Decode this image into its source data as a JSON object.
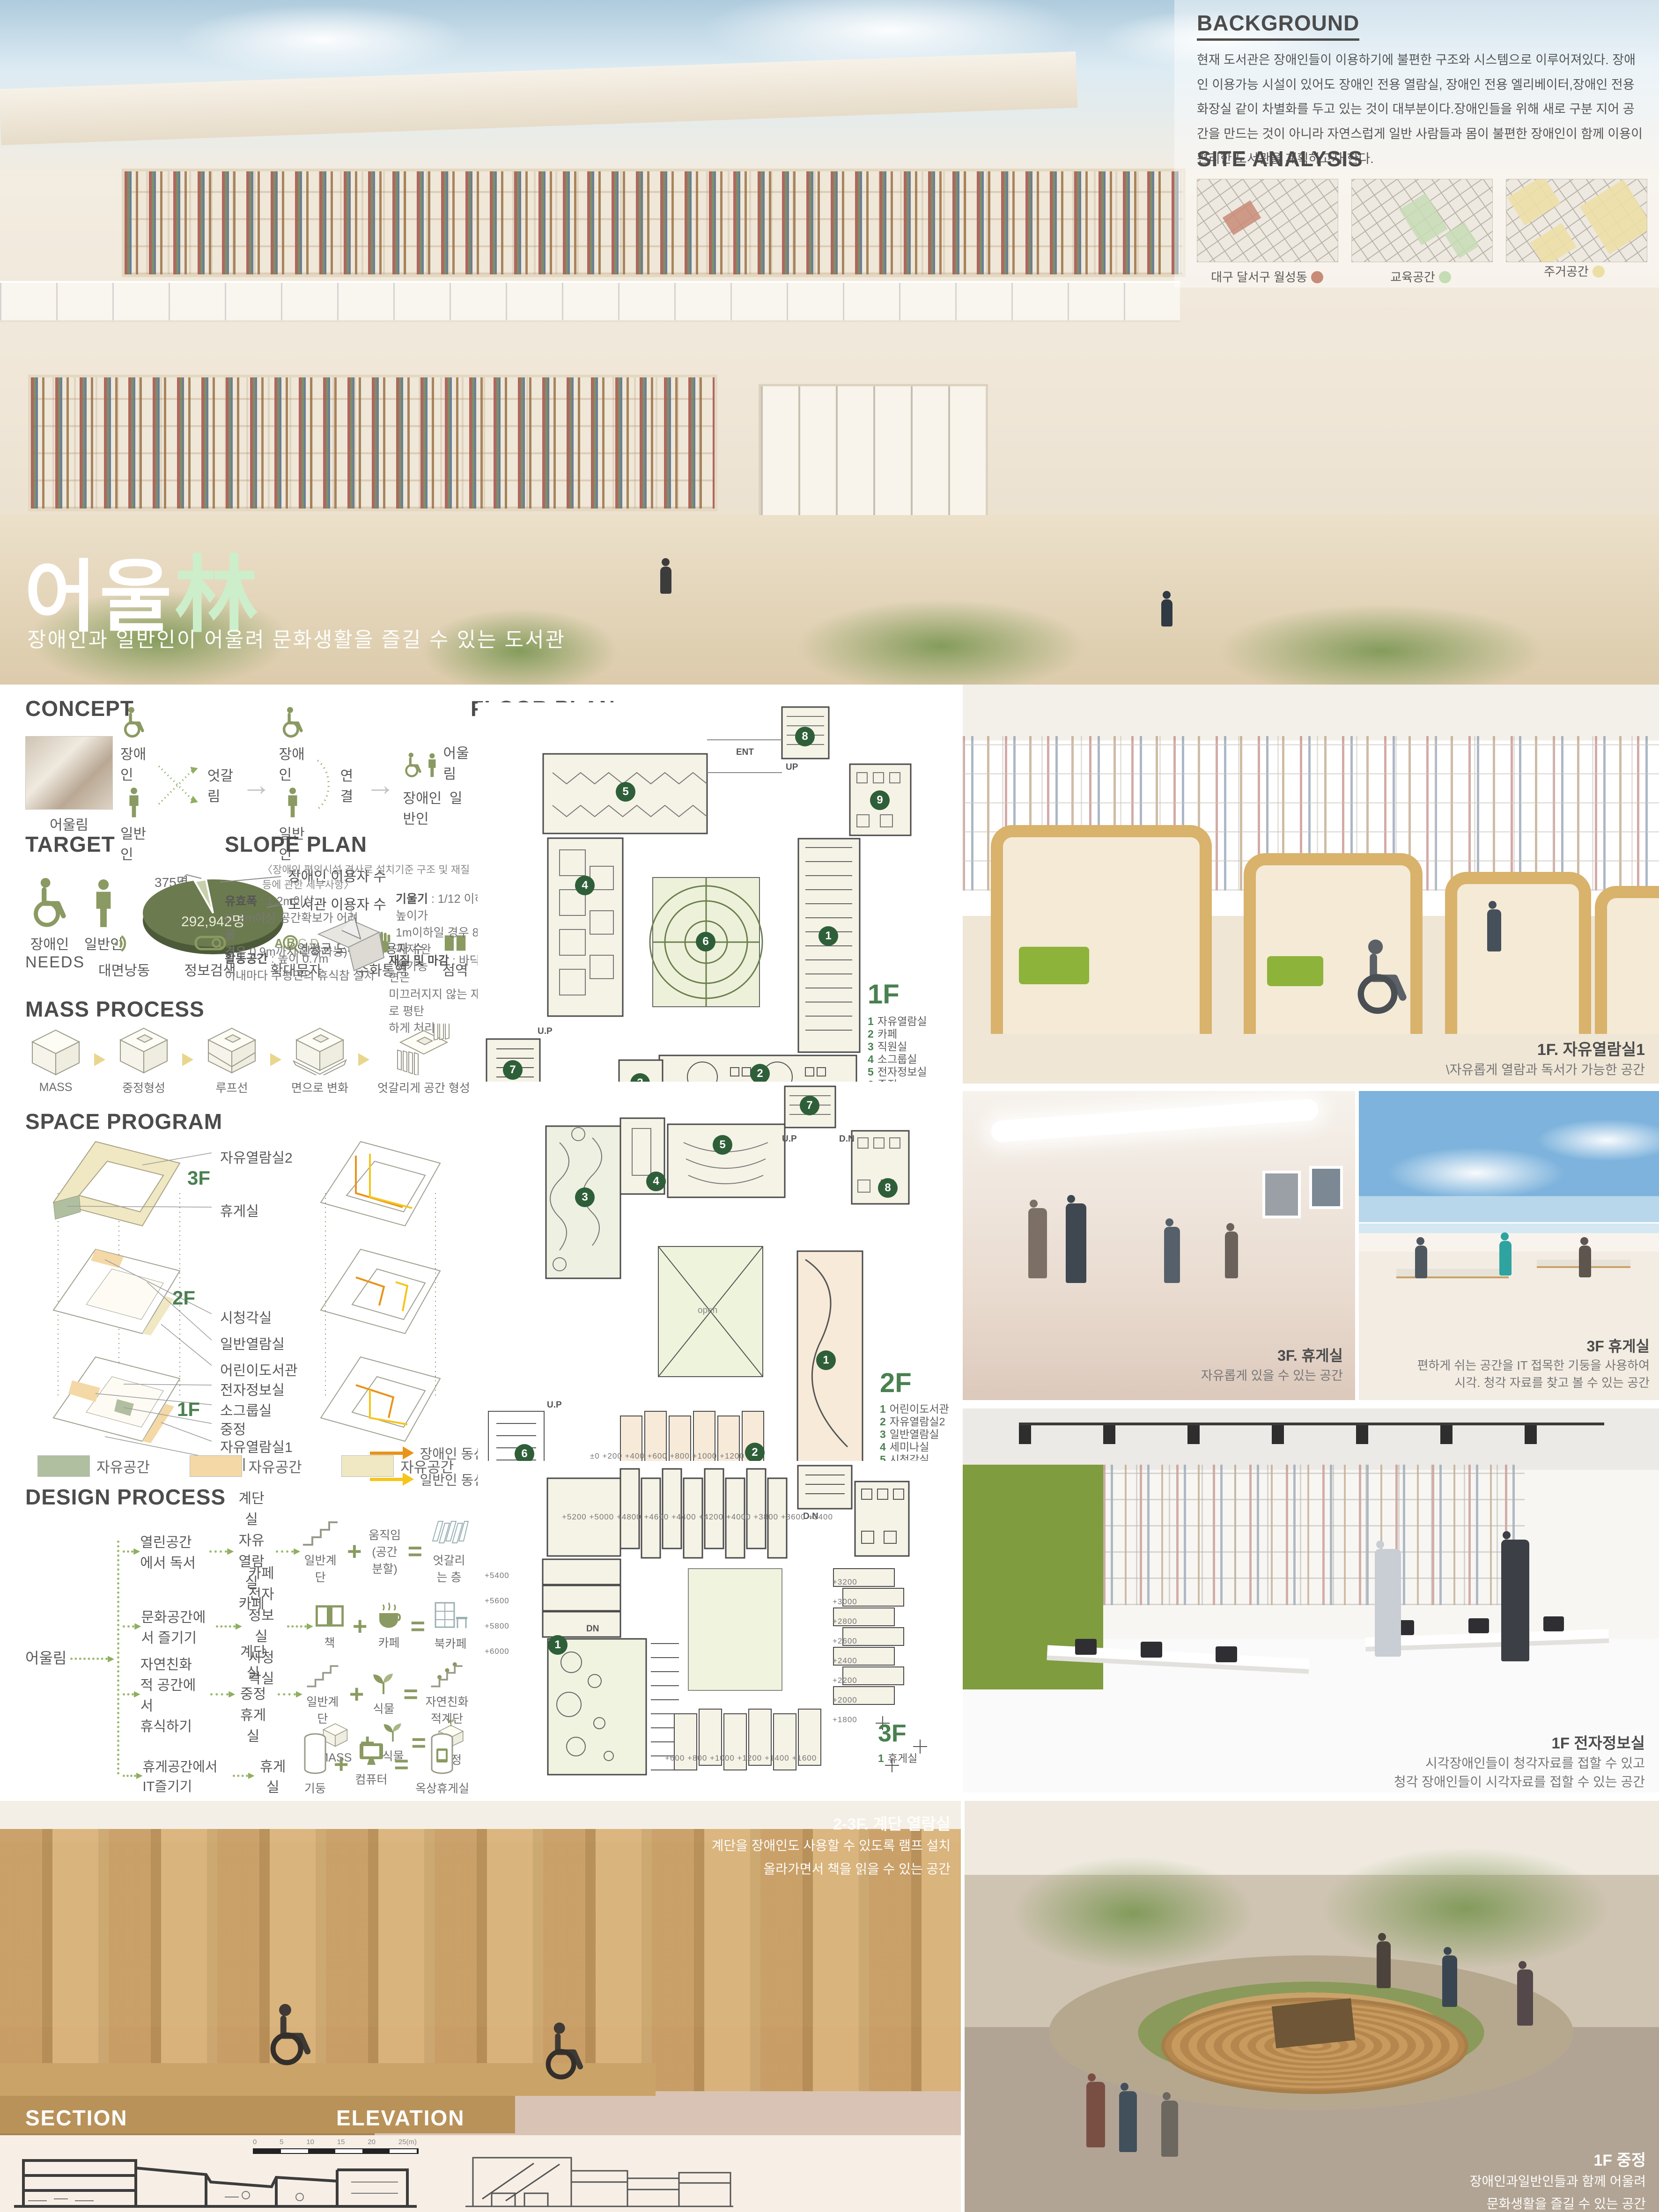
{
  "hero": {
    "title_white": "어울",
    "title_green": "林",
    "subtitle": "장애인과 일반인이 어울려 문화생활을 즐길 수 있는 도서관"
  },
  "background": {
    "heading": "BACKGROUND",
    "body": "현재 도서관은 장애인들이 이용하기에 불편한 구조와 시스템으로 이루어져있다. 장애인 이용가능 시설이 있어도 장애인 전용 열람실, 장애인 전용 엘리베이터,장애인 전용 화장실 같이 차별화를 두고 있는 것이 대부분이다.장애인들을 위해 새로 구분 지어 공간을 만드는 것이 아니라 자연스럽게 일반 사람들과 몸이 불편한 장애인이 함께 이용이 편리한 도서관을 계획하고자 한다."
  },
  "site_analysis": {
    "heading": "SITE ANALYSIS",
    "maps": [
      {
        "label": "대구 달서구 월성동",
        "dot_color": "#c88b76"
      },
      {
        "label": "교육공간",
        "dot_color": "#c6dcb4"
      },
      {
        "label": "주거공간",
        "dot_color": "#ecdfa6"
      }
    ]
  },
  "concept": {
    "heading": "CONCEPT",
    "photo_caption": "어울림",
    "disabled_label": "장애인",
    "general_label": "일반인",
    "cross_label": "엇갈림",
    "link_label": "연결",
    "merge_label": "어울림",
    "merge_disabled": "장애인",
    "merge_general": "일반인"
  },
  "target": {
    "heading": "TARGET",
    "disabled_label": "장애인",
    "general_label": "일반인",
    "pie": {
      "small_value": "375명",
      "small_label": "장애인 이용자 수",
      "total_value": "292,942명",
      "total_label": "도서관 이용자 수",
      "caption": "〈 연평균 도서관  이용자 수 〉"
    },
    "needs_label": "NEEDS",
    "needs": [
      "대면낭동",
      "정보검색",
      "확대문자",
      "수화통역",
      "점역"
    ]
  },
  "slope_plan": {
    "heading": "SLOPE PLAN",
    "note": "〈장애인  편의시설 경사로 설치기준 구조 및 재질등에 관한 세부사항〉",
    "items": [
      {
        "term": "유효폭",
        "desc": "1.2m이상\n(1.2m이상 공간확보가 어려울\n경우 0.9m까지 완화가능)"
      },
      {
        "term": "기울기",
        "desc": "1/12 이하 높이가\n1m이하일 경우 8/1까지 완\n화가능"
      },
      {
        "term": "활동공간",
        "desc": "높이 0.7m\n이내마다 수평면의 휴식참 설치"
      },
      {
        "term": "재질 및 마감",
        "desc": "바닥표면은\n미끄러지지 않는 재질로 평탄\n하게 처리"
      }
    ]
  },
  "mass_process": {
    "heading": "MASS PROCESS",
    "steps": [
      "MASS",
      "중정형성",
      "루프선",
      "면으로 변화",
      "엇갈리게 공간 형성"
    ]
  },
  "space_program": {
    "heading": "SPACE PROGRAM",
    "tags": [
      "3F",
      "2F",
      "1F"
    ],
    "labels_3f": [
      "자유열람실2",
      "휴게실"
    ],
    "labels_2f": [
      "시청각실",
      "일반열람실",
      "어린이도서관"
    ],
    "labels_1f": [
      "전자정보실",
      "소그룹실",
      "중정",
      "자유열람실1",
      "카페"
    ],
    "legend": [
      {
        "label": "자유공간",
        "color": "#b0bfa0"
      },
      {
        "label": "자유공간",
        "color": "#f4d8a5"
      },
      {
        "label": "자유공간",
        "color": "#efe8c2"
      }
    ],
    "flow_legend": [
      {
        "label": "장애인 동선",
        "color": "#e8941a"
      },
      {
        "label": "일반인 동선",
        "color": "#f6c51c"
      }
    ]
  },
  "design_process": {
    "heading": "DESIGN PROCESS",
    "root": "어울림",
    "rows": [
      {
        "need": "열린공간에서 독서",
        "spaces": [
          "계단실",
          "자유열람실",
          "카페"
        ],
        "a": "일반계단",
        "b": "움직임\n(공간 분할)",
        "c": "엇갈리는 층"
      },
      {
        "need": "문화공간에서 즐기기",
        "spaces": [
          "카페",
          "전자정보실",
          "시청각실"
        ],
        "a": "책",
        "b": "카페",
        "c": "북카페"
      },
      {
        "need": "자연친화적 공간에서\n휴식하기",
        "spaces": [
          "계단실",
          "중정",
          "휴게실"
        ],
        "a": "일반계단",
        "b": "식물",
        "c": "자연친화적계단",
        "a2": "MASS",
        "b2": "식물",
        "c2": "중정"
      },
      {
        "need": "휴게공간에서 IT즐기기",
        "spaces": [
          "휴게실"
        ],
        "a": "기둥",
        "b": "컴퓨터",
        "c": "옥상휴게실"
      }
    ]
  },
  "floor_plan": {
    "heading": "FLOOR PLAN",
    "floor1": {
      "tag": "1F",
      "legend": [
        {
          "n": "1",
          "label": "자유열람실"
        },
        {
          "n": "2",
          "label": "카페"
        },
        {
          "n": "3",
          "label": "직원실"
        },
        {
          "n": "4",
          "label": "소그룹실"
        },
        {
          "n": "5",
          "label": "전자정보실"
        },
        {
          "n": "6",
          "label": "중정"
        },
        {
          "n": "7",
          "label": "계단실1"
        },
        {
          "n": "8",
          "label": "계단실2"
        },
        {
          "n": "9",
          "label": "화장실"
        }
      ],
      "scale": [
        "0",
        "5",
        "10",
        "15",
        "20",
        "25(m)"
      ],
      "markers": {
        "ent_top": "ENT",
        "up": "UP",
        "up2": "U.P",
        "ent_bottom": "ENT"
      }
    },
    "floor2": {
      "tag": "2F",
      "legend": [
        {
          "n": "1",
          "label": "어린이도서관"
        },
        {
          "n": "2",
          "label": "자유열람실2"
        },
        {
          "n": "3",
          "label": "일반열람실"
        },
        {
          "n": "4",
          "label": "세미나실"
        },
        {
          "n": "5",
          "label": "시청각실"
        },
        {
          "n": "6",
          "label": "계단실1"
        },
        {
          "n": "7",
          "label": "계단실2"
        },
        {
          "n": "8",
          "label": "화장실"
        }
      ],
      "levels": [
        "±0",
        "+200",
        "+400",
        "+600",
        "+800",
        "+1000",
        "+1200"
      ],
      "markers": {
        "up": "U.P",
        "dn": "D.N",
        "up2": "U.P",
        "dn2": "D.N",
        "open": "open"
      }
    },
    "floor3": {
      "tag": "3F",
      "legend": [
        {
          "n": "1",
          "label": "휴게실"
        }
      ],
      "levels_top": [
        "+5200",
        "+5000",
        "+4800",
        "+4600",
        "+4400",
        "+4200",
        "+4000",
        "+3800",
        "+3600",
        "+3400"
      ],
      "levels_left": [
        "+5400",
        "+5600",
        "+5800",
        "+6000"
      ],
      "levels_right": [
        "+3200",
        "+3000",
        "+2800",
        "+2600",
        "+2400",
        "+2200",
        "+2000",
        "+1800"
      ],
      "levels_bottom": [
        "+600",
        "+800",
        "+1000",
        "+1200",
        "+1400",
        "+1600"
      ],
      "markers": {
        "dn": "D.N",
        "dn2": "DN"
      }
    }
  },
  "renders": {
    "reading1": {
      "title": "1F. 자유열람실1",
      "desc": "\\자유롭게 열람과 독서가 가능한 공간"
    },
    "lounge_hall": {
      "title": "3F. 휴게실",
      "desc": "자유롭게 있을 수 있는 공간"
    },
    "lounge_roof": {
      "title": "3F 휴게실",
      "desc": "편하게 쉬는 공간을 IT 접목한 기둥을 사용하여\n시각. 청각 자료를 찾고 볼 수 있는 공간"
    },
    "digital": {
      "title": "1F 전자정보실",
      "desc": "시각장애인들이 청각자료를 접할 수 있고\n청각 장애인들이 시각자료를 접할 수 있는 공간"
    },
    "stairs": {
      "title": "2-3F. 계단 열람실",
      "desc": "계단을 장애인도 사용할 수 있도록 램프 설치\n올라가면서 책을 읽을 수 있는 공간"
    },
    "courtyard": {
      "title": "1F 중정",
      "desc": "장애인과일반인들과 함께 어울려\n문화생활을 즐길 수 있는 공간"
    }
  },
  "section_elevation": {
    "section_heading": "SECTION",
    "elevation_heading": "ELEVATION",
    "scale": [
      "0",
      "5",
      "10",
      "15",
      "20",
      "25(m)"
    ]
  }
}
